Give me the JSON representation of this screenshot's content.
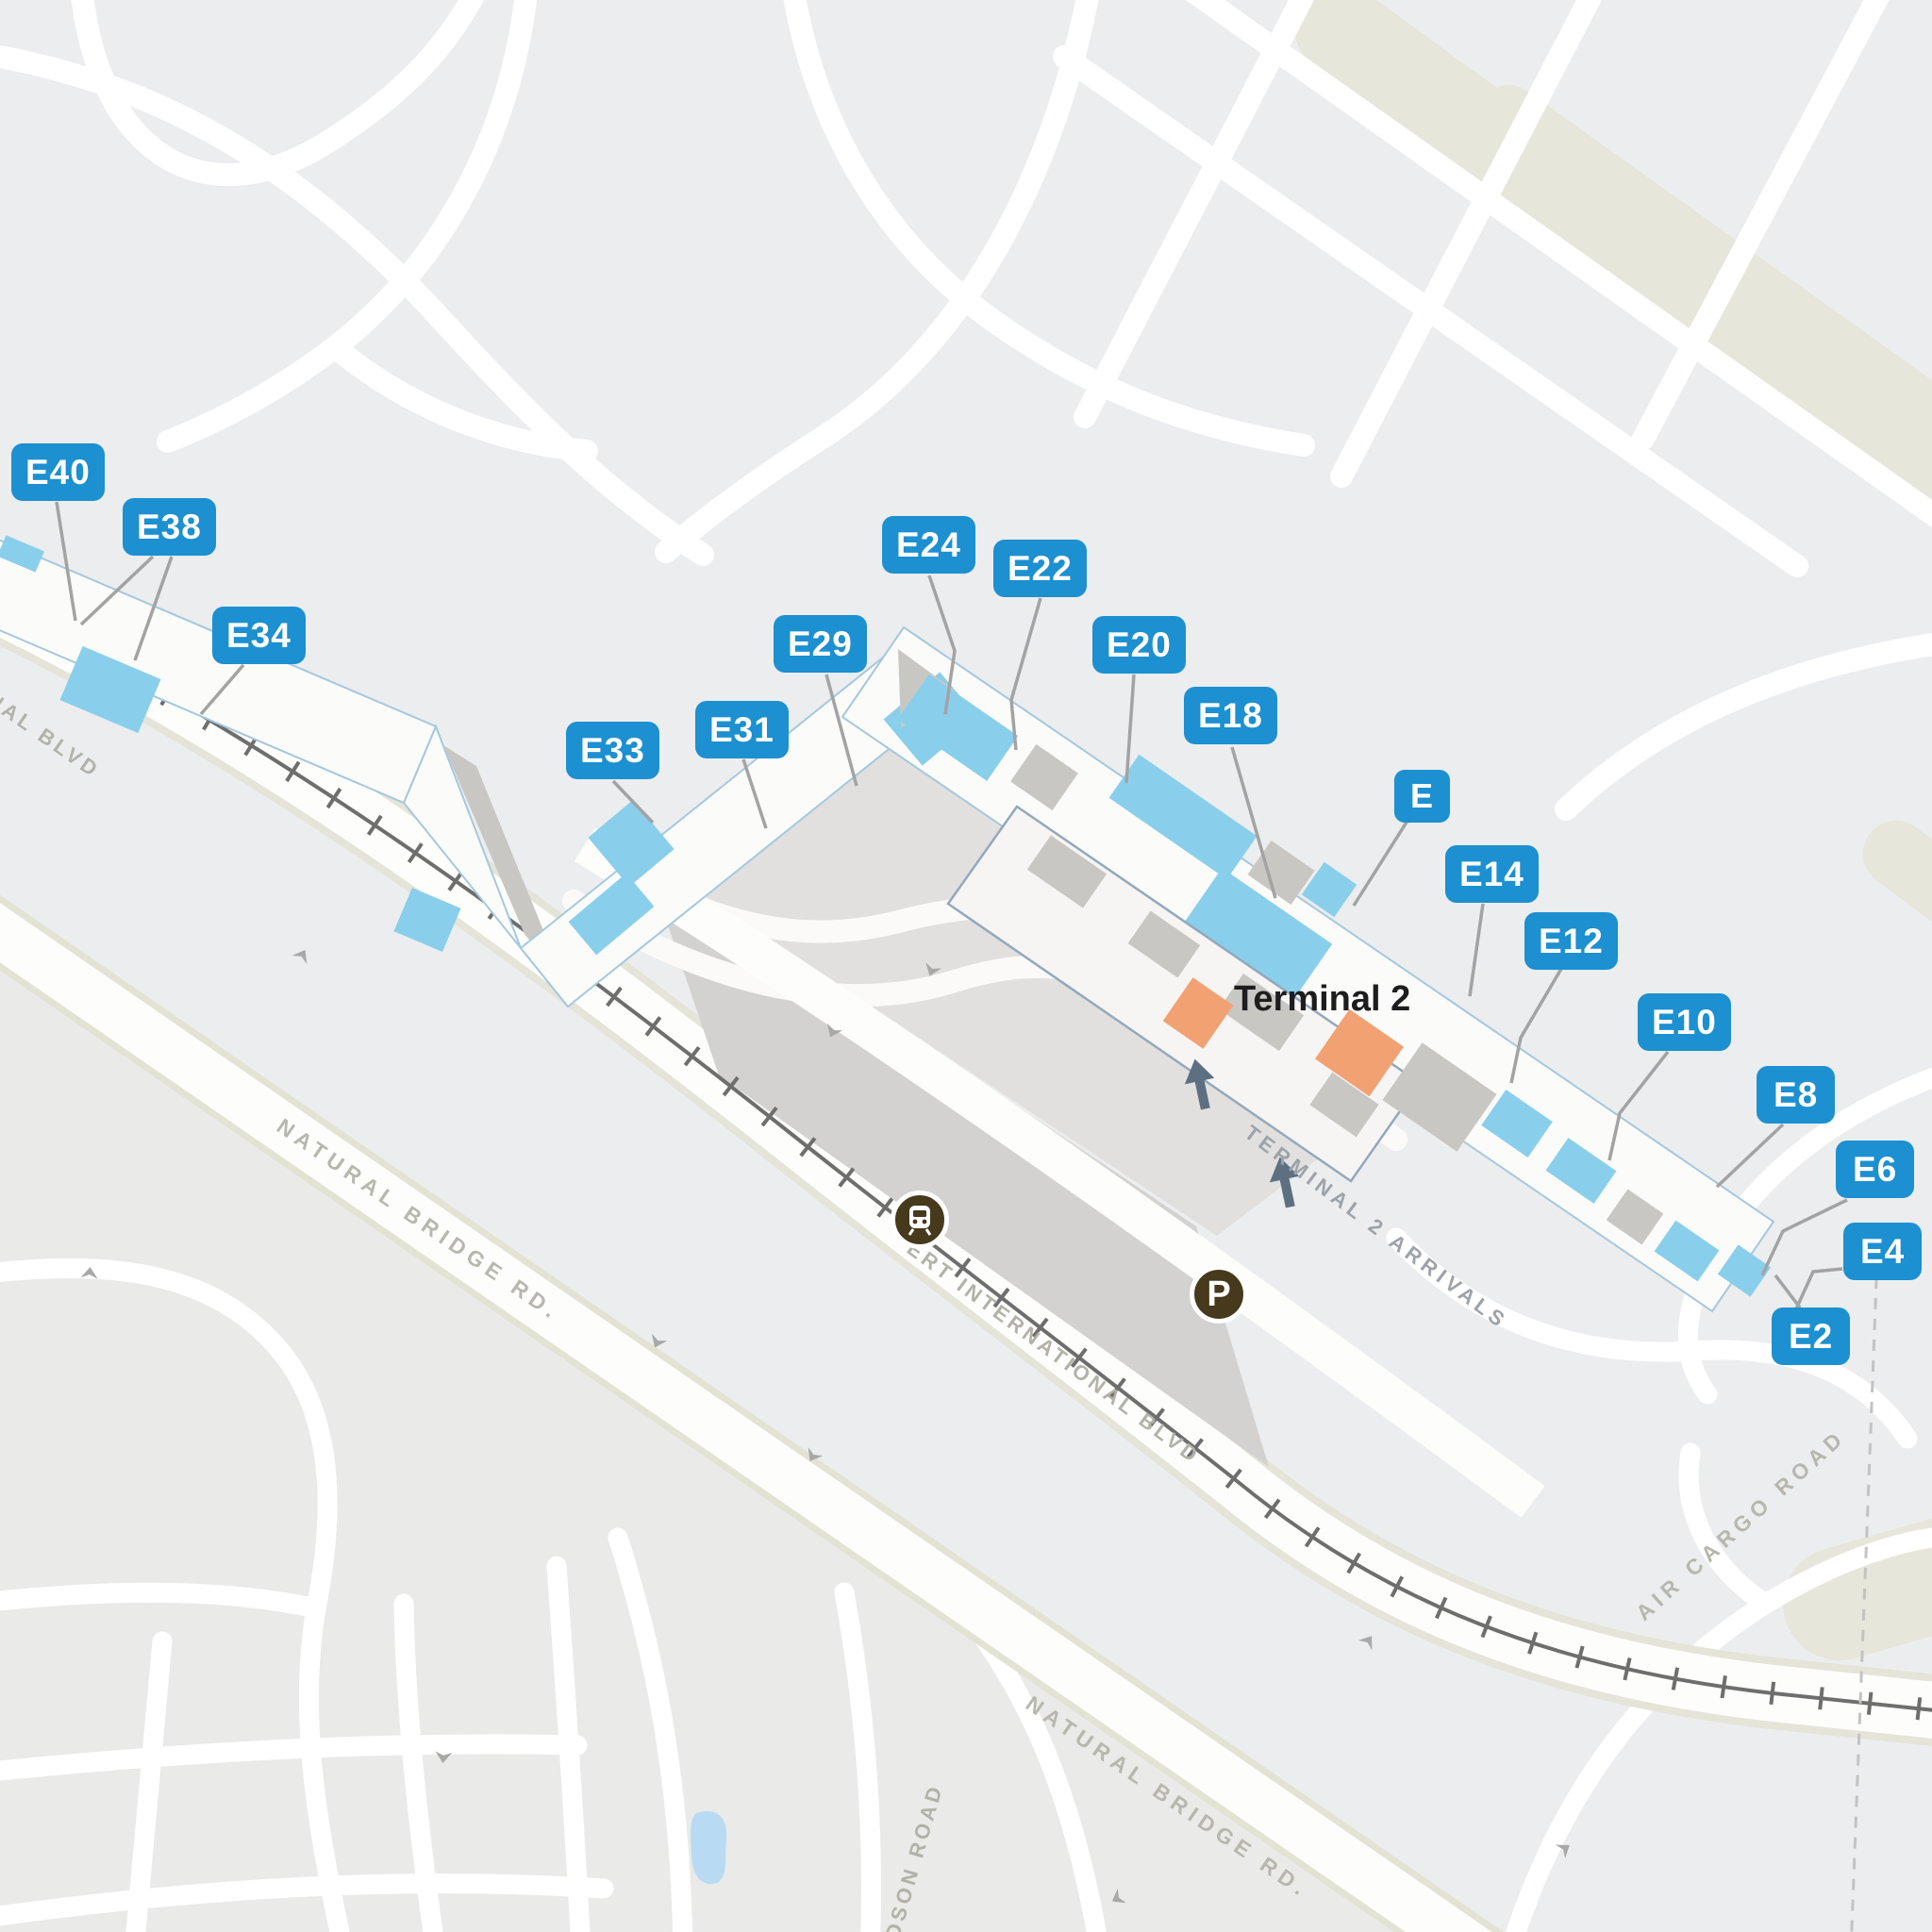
{
  "terminal": {
    "name": "Terminal 2"
  },
  "concourse": {
    "badge": "E"
  },
  "gates": [
    {
      "label": "E40"
    },
    {
      "label": "E38"
    },
    {
      "label": "E34"
    },
    {
      "label": "E33"
    },
    {
      "label": "E31"
    },
    {
      "label": "E29"
    },
    {
      "label": "E24"
    },
    {
      "label": "E22"
    },
    {
      "label": "E20"
    },
    {
      "label": "E18"
    },
    {
      "label": "E14"
    },
    {
      "label": "E12"
    },
    {
      "label": "E10"
    },
    {
      "label": "E8"
    },
    {
      "label": "E6"
    },
    {
      "label": "E4"
    },
    {
      "label": "E2"
    }
  ],
  "roads": {
    "natural_bridge_1": "NATURAL BRIDGE RD.",
    "natural_bridge_2": "NATURAL BRIDGE RD.",
    "intl_blvd_partial": "NAL BLVD",
    "lambert_intl_partial": "ERT INTERNATIONAL BLVD",
    "terminal_arrivals": "TERMINAL 2 ARRIVALS",
    "air_cargo": "AIR CARGO ROAD",
    "edmundson_partial": "DSON ROAD"
  },
  "transit": {
    "parking_label": "P",
    "train_station": "train-station"
  },
  "colors": {
    "badge_blue": "#1c90d0",
    "gate_blue": "#89cfec",
    "building_gray": "#c9c7c3",
    "terminal_orange": "#f2a173",
    "icon_brown": "#46391c",
    "garage_gray": "#d3d2d0"
  }
}
